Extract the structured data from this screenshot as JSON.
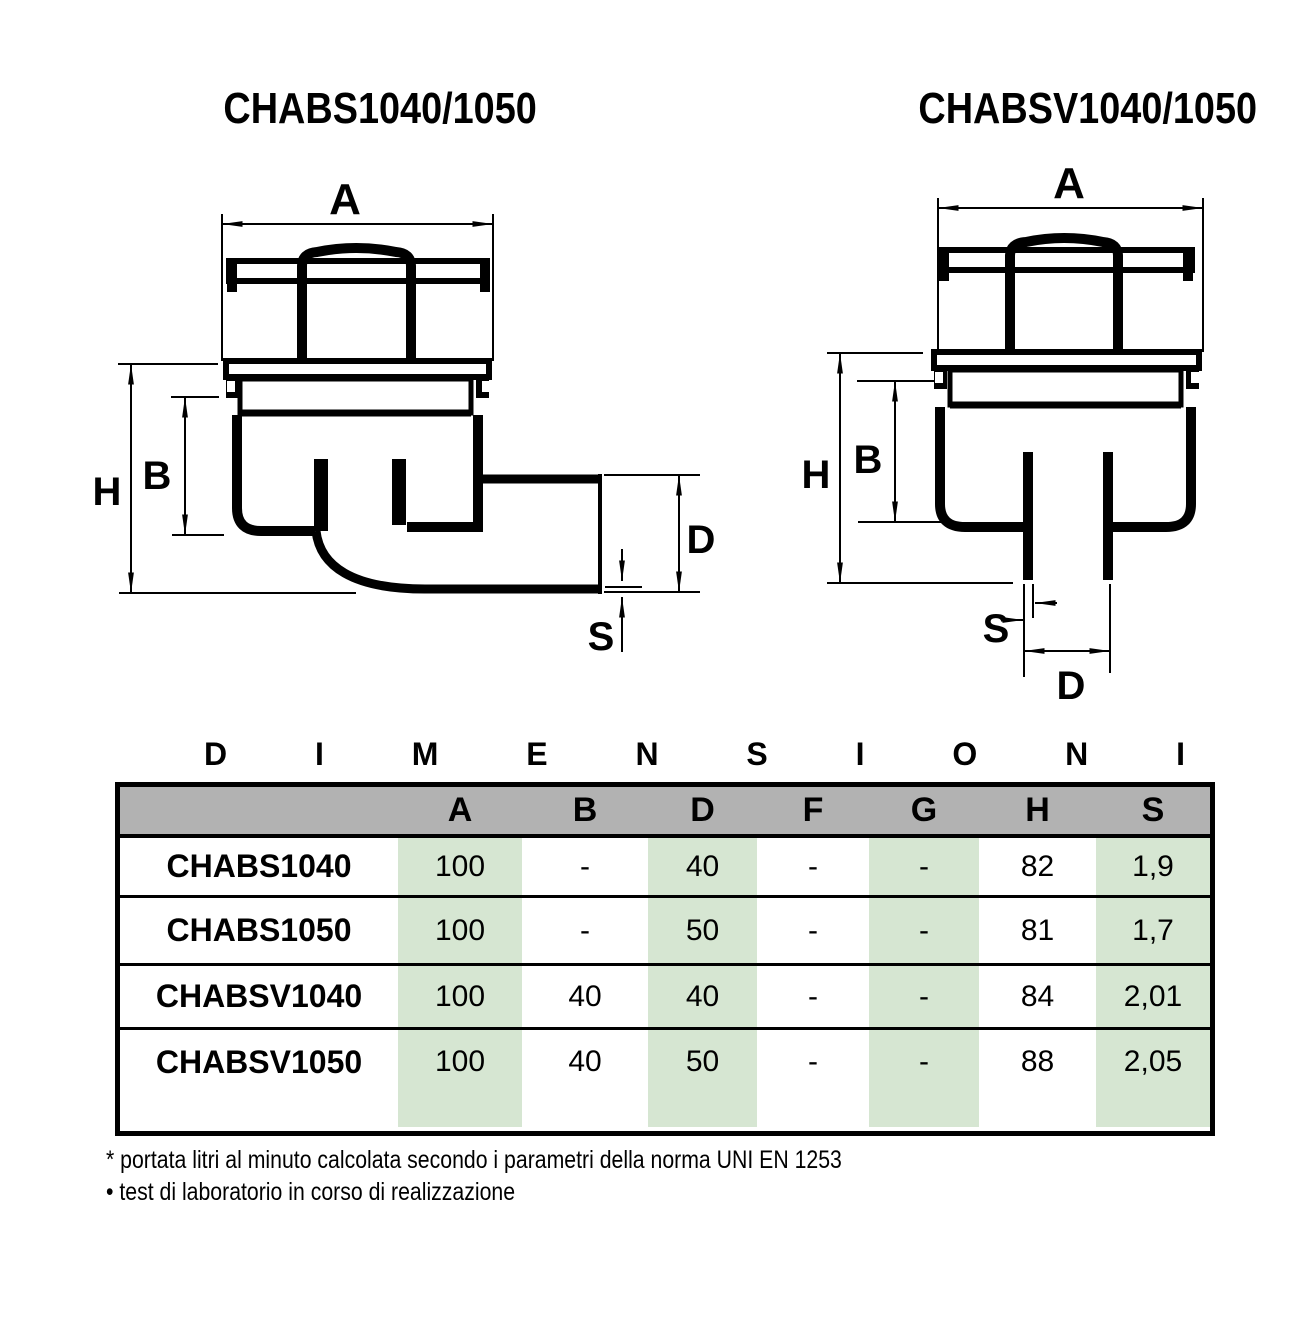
{
  "diagrams": {
    "left": {
      "title": "CHABS1040/1050",
      "labels": {
        "A": "A",
        "B": "B",
        "H": "H",
        "D": "D",
        "S": "S"
      }
    },
    "right": {
      "title": "CHABSV1040/1050",
      "labels": {
        "A": "A",
        "B": "B",
        "H": "H",
        "D": "D",
        "S": "S"
      }
    }
  },
  "dimensions_heading": {
    "letters": [
      "D",
      "I",
      "M",
      "E",
      "N",
      "S",
      "I",
      "O",
      "N",
      "I"
    ]
  },
  "table": {
    "header": [
      "A",
      "B",
      "D",
      "F",
      "G",
      "H",
      "S"
    ],
    "rows": [
      {
        "name": "CHABS1040",
        "values": [
          "100",
          "-",
          "40",
          "-",
          "-",
          "82",
          "1,9"
        ]
      },
      {
        "name": "CHABS1050",
        "values": [
          "100",
          "-",
          "50",
          "-",
          "-",
          "81",
          "1,7"
        ]
      },
      {
        "name": "CHABSV1040",
        "values": [
          "100",
          "40",
          "40",
          "-",
          "-",
          "84",
          "2,01"
        ]
      },
      {
        "name": "CHABSV1050",
        "values": [
          "100",
          "40",
          "50",
          "-",
          "-",
          "88",
          "2,05"
        ]
      }
    ],
    "highlighted_columns": [
      "A",
      "D",
      "G",
      "S"
    ]
  },
  "colors": {
    "highlight_green": "#d6e6d2",
    "header_gray": "#b2b2b2",
    "ink": "#000000"
  },
  "footnotes": [
    "* portata litri al minuto calcolata secondo i parametri della norma UNI EN 1253",
    "• test di laboratorio in corso di realizzazione"
  ]
}
